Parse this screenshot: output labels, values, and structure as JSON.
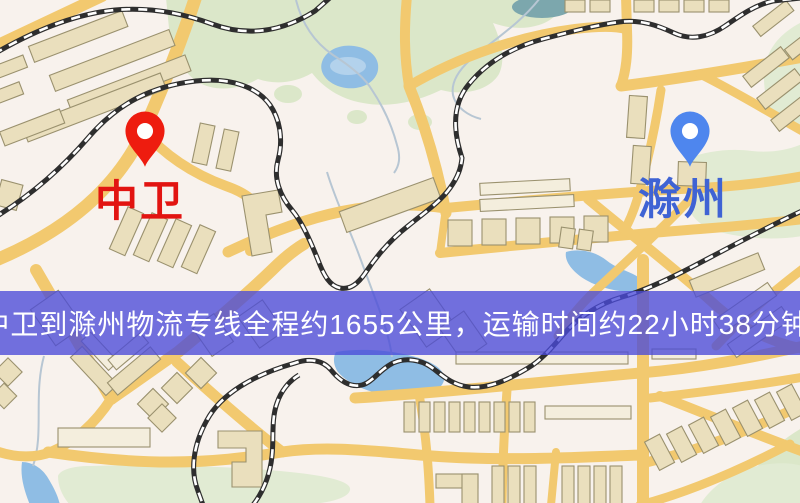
{
  "map": {
    "kind": "street-map",
    "features": [
      "roads",
      "railways",
      "buildings",
      "parks",
      "water"
    ]
  },
  "markers": {
    "origin": {
      "label": "中卫",
      "color": "#e21411",
      "pin_color": "#ee1c0f",
      "icon": "red-location-pin"
    },
    "destination": {
      "label": "滁州",
      "color": "#3f63d4",
      "pin_color": "#4e86ee",
      "icon": "blue-location-pin"
    }
  },
  "banner": {
    "text": "中卫到滁州物流专线全程约1655公里，运输时间约22小时38分钟.",
    "background": "#4a4ad8",
    "text_color": "#ffffff"
  },
  "route": {
    "origin": "中卫",
    "destination": "滁州",
    "distance_km": "1655",
    "duration": "22小时38分钟"
  }
}
